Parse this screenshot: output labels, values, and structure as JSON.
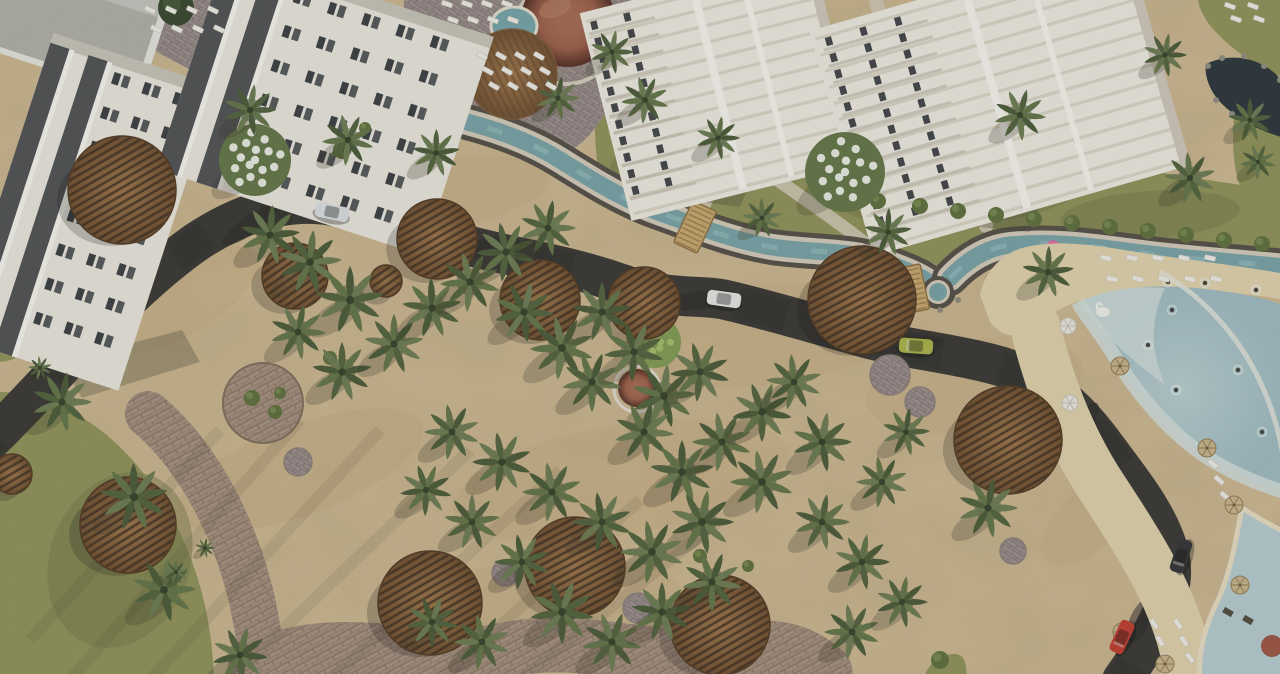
{
  "scene": {
    "width": 1280,
    "height": 674,
    "kind": "aerial-resort-rendering"
  },
  "palette": {
    "sand": "#d5c095",
    "sandDark": "#c2a173",
    "road": "#31302b",
    "roadDark": "#242320",
    "grass": "#8d9052",
    "grassDark": "#6e7440",
    "canalStone": "#4e483f",
    "canalRim": "#d6cdba",
    "canalWater": "#74a2a6",
    "canalRipple": "#9ec7c6",
    "brick": "#a5917f",
    "brickJoint": "#8b7663",
    "plaza": "#9b8e8b",
    "plazaJoint": "#7f7370",
    "gravel": "#d2c9b2",
    "woodLight": "#8f673c",
    "woodDark": "#5d3f22",
    "slat": "#332313",
    "domeHi": "#9a5a42",
    "domeLo": "#4e241a",
    "facade": "#eceadf",
    "facadeDark": "#3a3d40",
    "window": "#33373b",
    "towerFace": "#f1eee4",
    "towerStripe": "#d8d2c1",
    "towerWin": "#3b3e42",
    "waterDeep": "#9dbcc3",
    "waterMid": "#b9d0d2",
    "waterShallow": "#d3e0dc",
    "poolRim": "#ead fc4",
    "lounger": "#f3f1ea",
    "pond": "#222e33",
    "carWhite1": "#dde2e4",
    "carWhite2": "#e9e9e7",
    "carLime": "#a9b243",
    "carDark": "#2b2b2e",
    "carRed": "#c13527",
    "floatPink": "#e2699f",
    "swanWhite": "#f4f4f0",
    "blossom": "#f2f5ee"
  },
  "road": {
    "d": "M -25 455 C 45 390 115 300 195 243 C 238 214 285 198 333 206 C 385 215 420 233 470 246 C 520 259 565 264 622 284 C 672 301 700 294 726 300 C 765 309 805 321 862 337 C 905 349 945 352 992 364 C 1040 376 1072 402 1102 442 C 1130 480 1162 518 1170 558 C 1177 596 1152 638 1122 680",
    "width": 40,
    "smudges": [
      [
        250,
        225,
        34,
        9,
        -35
      ],
      [
        480,
        248,
        40,
        9,
        -10
      ],
      [
        700,
        300,
        38,
        9,
        -8
      ],
      [
        900,
        345,
        42,
        9,
        -5
      ],
      [
        1080,
        428,
        30,
        10,
        -55
      ],
      [
        1152,
        556,
        26,
        11,
        -80
      ],
      [
        1140,
        620,
        24,
        10,
        -65
      ]
    ]
  },
  "canal": {
    "main": "M 238 -15 C 244 30 246 62 252 86 C 262 122 300 104 330 108 C 365 112 395 108 430 114 C 470 121 520 135 560 160 C 600 185 625 200 658 212 C 692 224 730 240 772 247 C 812 253 850 250 884 262 C 912 272 930 280 938 291",
    "lagoonArm": "M 950 278 C 965 262 985 248 1010 245 C 1060 240 1100 248 1150 254 C 1200 260 1250 263 1295 268",
    "stoneW": 36,
    "rimW": 26,
    "waterW": 17,
    "bulge": [
      938,
      292
    ],
    "rocks": [
      [
        205,
        62
      ],
      [
        216,
        84
      ],
      [
        230,
        100
      ],
      [
        258,
        104
      ],
      [
        940,
        310
      ],
      [
        958,
        300
      ],
      [
        920,
        300
      ]
    ]
  },
  "grass": [
    "M 0 392 C 30 392 60 402 92 424 C 130 450 162 492 185 544 C 203 586 212 628 214 678 L 0 678 Z",
    "M 0 330 L 36 336 C 30 352 18 360 0 362 Z",
    "M 598 172 C 610 140 640 110 688 100 C 740 92 800 108 860 120 C 930 134 1000 146 1070 158 C 1140 170 1210 180 1285 192 L 1285 250 C 1240 258 1190 252 1140 248 C 1090 244 1040 240 1005 244 C 980 247 962 258 948 272 C 930 258 900 252 868 254 C 820 258 780 250 740 240 C 700 230 660 210 630 190 C 615 180 602 176 598 172 Z",
    "M 598 170 C 592 120 594 70 604 30 C 612 0 618 -5 630 -5 L 672 -5 C 660 40 655 80 655 120 C 640 140 615 160 598 170 Z",
    "M 1198 0 L 1285 0 L 1285 78 C 1258 68 1232 50 1212 28 C 1204 18 1199 8 1198 0 Z",
    "M 1238 92 C 1252 86 1268 84 1285 86 L 1285 228 C 1268 220 1252 208 1242 190 C 1232 170 1230 130 1238 92 Z",
    "M 924 678 C 928 664 938 656 952 654 C 962 653 968 660 966 678 Z"
  ],
  "grassShade": [
    [
      120,
      560,
      70,
      90,
      20
    ],
    [
      700,
      160,
      90,
      34,
      -6
    ],
    [
      960,
      195,
      120,
      30,
      -4
    ],
    [
      1150,
      215,
      90,
      24,
      -4
    ]
  ],
  "plazas": [
    "M 404 0 L 632 0 L 628 58 C 618 92 610 108 602 118 C 588 140 572 152 560 156 C 540 142 520 134 498 130 C 474 124 450 120 430 116 L 402 56 Z",
    "M 138 0 L 240 0 L 250 52 C 236 66 222 74 208 78 C 186 68 164 56 146 46 Z"
  ],
  "brickPaths": [
    {
      "d": "M 148 414 C 205 462 238 540 252 600 C 259 634 262 655 263 678",
      "w": 46
    },
    {
      "d": "M 255 668 C 340 628 420 668 505 650 C 590 632 650 668 730 652 C 770 644 800 648 825 672",
      "w": 55
    }
  ],
  "gravelPaths": [
    {
      "d": "M 876 2 C 892 50 912 88 944 126 C 968 156 982 190 986 226",
      "w": 14
    },
    {
      "d": "M 640 -4 C 628 20 618 44 616 66",
      "w": 12
    },
    {
      "d": "M 697 222 C 712 190 724 160 734 128",
      "w": 12
    },
    {
      "d": "M 772 176 C 826 214 874 246 908 282",
      "w": 13
    }
  ],
  "sandPatches": [
    [
      430,
      195,
      120,
      36,
      -8
    ],
    [
      760,
      335,
      150,
      50,
      -6
    ],
    [
      975,
      385,
      110,
      45,
      -10
    ],
    [
      300,
      470,
      130,
      45,
      -20
    ],
    [
      620,
      480,
      170,
      55,
      -10
    ],
    [
      180,
      300,
      90,
      35,
      -30
    ],
    [
      1090,
      520,
      60,
      30,
      -40
    ],
    [
      540,
      600,
      140,
      40,
      -5
    ]
  ],
  "shadowStreaks": [
    [
      70,
      680,
      300,
      420
    ],
    [
      150,
      680,
      380,
      430
    ],
    [
      230,
      680,
      470,
      450
    ],
    [
      330,
      680,
      560,
      470
    ],
    [
      440,
      680,
      640,
      500
    ],
    [
      30,
      640,
      220,
      430
    ],
    [
      520,
      680,
      720,
      520
    ]
  ],
  "lagoon": {
    "beach": "M 980 295 C 985 272 1000 255 1022 248 C 1060 238 1100 246 1150 254 C 1205 262 1255 268 1285 274 L 1285 300 C 1240 292 1180 286 1130 290 C 1090 294 1058 306 1035 326 C 1020 340 1002 338 990 322 Z",
    "beachBand": "M 1035 326 C 1048 380 1070 440 1105 492 C 1140 545 1168 590 1182 640 C 1188 660 1186 670 1184 678",
    "water": "M 1078 302 C 1110 288 1150 284 1195 288 C 1240 292 1272 300 1285 306 L 1285 492 C 1258 484 1230 472 1205 456 C 1172 434 1140 398 1118 362 C 1100 332 1085 316 1078 302 Z",
    "shallowWedge": "M 1078 302 C 1110 288 1140 286 1165 288 C 1150 320 1150 350 1165 385 C 1130 360 1100 330 1082 308 Z",
    "shallowEdge": "M 1078 302 C 1085 316 1100 332 1118 362 C 1140 398 1172 434 1205 456 C 1230 472 1258 484 1285 492",
    "waveArc": "M 1160 272 C 1210 300 1248 348 1268 400 C 1280 432 1284 458 1284 470",
    "kidsPool": "M 1242 508 C 1258 518 1272 526 1285 532 L 1285 678 L 1200 678 C 1198 654 1204 628 1218 600 C 1230 574 1236 540 1242 508 Z",
    "playground": [
      [
        1228,
        612
      ],
      [
        1248,
        620
      ]
    ],
    "terracotta": [
      1272,
      646,
      11
    ]
  },
  "pond": {
    "d": "M 1206 64 C 1226 54 1250 56 1268 68 C 1280 76 1285 84 1285 92 L 1285 138 C 1262 132 1238 120 1222 104 C 1210 92 1204 76 1206 64 Z",
    "rocks": [
      [
        1208,
        66
      ],
      [
        1222,
        58
      ],
      [
        1244,
        56
      ],
      [
        1264,
        66
      ],
      [
        1280,
        80
      ],
      [
        1216,
        100
      ],
      [
        1232,
        114
      ],
      [
        1252,
        124
      ]
    ]
  },
  "bridges": [
    {
      "x": 393,
      "y": 110,
      "rot": 95,
      "w": 42,
      "h": 24
    },
    {
      "x": 695,
      "y": 227,
      "rot": 115,
      "w": 46,
      "h": 26
    },
    {
      "x": 912,
      "y": 289,
      "rot": 78,
      "w": 46,
      "h": 26
    },
    {
      "x": 158,
      "y": 86,
      "rot": 20,
      "w": 38,
      "h": 20
    }
  ],
  "buildings": [
    {
      "cx": 86,
      "cy": 212,
      "rot": 18,
      "w": 172,
      "h": 320,
      "bands": [
        -86,
        -46
      ],
      "bandW": 20,
      "win": {
        "x0": -16,
        "y0": -142,
        "cols": 3,
        "rows": 8,
        "dx": 32,
        "dy": 36
      }
    },
    {
      "cx": 325,
      "cy": 103,
      "rot": 18,
      "w": 280,
      "h": 230,
      "bands": [
        -140,
        -98
      ],
      "bandW": 22,
      "win": {
        "x0": -62,
        "y0": -98,
        "cols": 5,
        "rows": 6,
        "dx": 36,
        "dy": 36
      }
    }
  ],
  "roofCorner": {
    "cx": 40,
    "cy": 18,
    "rot": 18
  },
  "buildingShadows": [
    "M 60 362 L 182 330 L 200 362 L 82 398 Z",
    "M 640 150 L 760 160 L 740 207 L 628 192 Z",
    "M 880 160 L 1052 174 L 1030 232 L 868 216 Z"
  ],
  "towers": [
    {
      "cx": 722,
      "cy": 88,
      "rot": -14,
      "w": 240,
      "h": 214,
      "floors": 12,
      "win": {
        "x0": -112,
        "y0": -96,
        "cols": 2,
        "rows": 11,
        "dx": 17,
        "dy": 17
      }
    },
    {
      "cx": 1000,
      "cy": 98,
      "rot": -16,
      "w": 330,
      "h": 234,
      "floors": 13,
      "win": {
        "x0": -152,
        "y0": -106,
        "cols": 3,
        "rows": 12,
        "dx": 18,
        "dy": 17
      }
    }
  ],
  "domeComplex": {
    "ring": [
      566,
      32,
      52
    ],
    "dome": [
      568,
      20,
      47
    ],
    "pool": [
      514,
      26,
      23,
      19
    ],
    "deck": [
      512,
      74,
      45
    ],
    "gazebo": {
      "ring": [
        637,
        389,
        23
      ],
      "dome": [
        637,
        388,
        19
      ]
    }
  },
  "parasols": [
    [
      122,
      190,
      54,
      -30
    ],
    [
      295,
      276,
      33,
      -35
    ],
    [
      437,
      239,
      40,
      -30
    ],
    [
      386,
      281,
      16,
      -35
    ],
    [
      540,
      300,
      40,
      -30
    ],
    [
      644,
      303,
      36,
      -35
    ],
    [
      862,
      300,
      54,
      -28
    ],
    [
      1008,
      440,
      54,
      -30
    ],
    [
      128,
      525,
      48,
      -32
    ],
    [
      430,
      603,
      52,
      -30
    ],
    [
      575,
      567,
      50,
      -28
    ],
    [
      720,
      625,
      50,
      -30
    ],
    [
      12,
      474,
      20,
      -30
    ]
  ],
  "paverCircles": [
    [
      340,
      152,
      25
    ],
    [
      890,
      375,
      20
    ],
    [
      920,
      402,
      15
    ],
    [
      298,
      462,
      14
    ],
    [
      505,
      573,
      13
    ],
    [
      638,
      608,
      15
    ],
    [
      1013,
      551,
      13
    ]
  ],
  "planter": [
    263,
    403,
    40
  ],
  "palms": [
    [
      250,
      110,
      26
    ],
    [
      348,
      140,
      26
    ],
    [
      436,
      153,
      24
    ],
    [
      558,
      98,
      22
    ],
    [
      612,
      52,
      22
    ],
    [
      645,
      100,
      24
    ],
    [
      718,
      138,
      22
    ],
    [
      762,
      218,
      20
    ],
    [
      888,
      232,
      24
    ],
    [
      1020,
      115,
      26
    ],
    [
      1165,
      55,
      22
    ],
    [
      1190,
      178,
      26
    ],
    [
      1250,
      120,
      22
    ],
    [
      1258,
      162,
      18
    ],
    [
      270,
      235,
      30
    ],
    [
      310,
      262,
      32
    ],
    [
      350,
      300,
      34
    ],
    [
      298,
      332,
      28
    ],
    [
      342,
      372,
      30
    ],
    [
      394,
      344,
      30
    ],
    [
      432,
      308,
      30
    ],
    [
      470,
      282,
      30
    ],
    [
      506,
      252,
      30
    ],
    [
      548,
      228,
      28
    ],
    [
      524,
      312,
      30
    ],
    [
      562,
      348,
      32
    ],
    [
      602,
      312,
      30
    ],
    [
      592,
      382,
      30
    ],
    [
      634,
      352,
      30
    ],
    [
      664,
      396,
      32
    ],
    [
      700,
      372,
      30
    ],
    [
      644,
      432,
      30
    ],
    [
      682,
      472,
      32
    ],
    [
      722,
      442,
      30
    ],
    [
      762,
      412,
      30
    ],
    [
      794,
      382,
      28
    ],
    [
      822,
      442,
      30
    ],
    [
      762,
      482,
      32
    ],
    [
      702,
      522,
      32
    ],
    [
      652,
      552,
      32
    ],
    [
      602,
      522,
      30
    ],
    [
      552,
      492,
      30
    ],
    [
      502,
      462,
      30
    ],
    [
      452,
      432,
      28
    ],
    [
      562,
      612,
      32
    ],
    [
      612,
      642,
      30
    ],
    [
      662,
      612,
      30
    ],
    [
      712,
      582,
      30
    ],
    [
      522,
      562,
      28
    ],
    [
      472,
      522,
      28
    ],
    [
      426,
      490,
      26
    ],
    [
      482,
      642,
      28
    ],
    [
      432,
      622,
      26
    ],
    [
      822,
      522,
      28
    ],
    [
      862,
      562,
      28
    ],
    [
      882,
      482,
      26
    ],
    [
      906,
      432,
      24
    ],
    [
      852,
      632,
      28
    ],
    [
      902,
      602,
      26
    ],
    [
      62,
      402,
      30
    ],
    [
      134,
      497,
      34
    ],
    [
      164,
      590,
      32
    ],
    [
      240,
      655,
      28
    ],
    [
      176,
      572,
      12
    ],
    [
      205,
      548,
      10
    ],
    [
      40,
      368,
      12
    ],
    [
      1048,
      272,
      26
    ],
    [
      988,
      508,
      30
    ]
  ],
  "bushes": [
    [
      920,
      206,
      8
    ],
    [
      958,
      211,
      8
    ],
    [
      996,
      215,
      8
    ],
    [
      1034,
      219,
      8
    ],
    [
      1072,
      223,
      8
    ],
    [
      1110,
      227,
      8
    ],
    [
      1148,
      231,
      8
    ],
    [
      1186,
      235,
      8
    ],
    [
      1224,
      240,
      8
    ],
    [
      1262,
      244,
      8
    ],
    [
      838,
      196,
      8
    ],
    [
      878,
      201,
      8
    ],
    [
      700,
      556,
      7
    ],
    [
      748,
      566,
      6
    ],
    [
      330,
      358,
      7
    ],
    [
      252,
      398,
      8
    ],
    [
      275,
      412,
      7
    ],
    [
      280,
      393,
      6
    ],
    [
      940,
      660,
      9
    ],
    [
      342,
      150,
      9
    ],
    [
      365,
      128,
      6
    ]
  ],
  "floweringTrees": [
    [
      255,
      160,
      36
    ],
    [
      845,
      172,
      40
    ]
  ],
  "lightTrees": [
    [
      655,
      342,
      26
    ]
  ],
  "darkTrees": [
    [
      176,
      8,
      18
    ]
  ],
  "loungerGroups": [
    {
      "x": 150,
      "y": 10,
      "cols": 4,
      "rows": 2,
      "dx": 21,
      "dy": 19,
      "rot": 25
    },
    {
      "x": 447,
      "y": 4,
      "cols": 4,
      "rows": 2,
      "dx": 20,
      "dy": 16,
      "rot": 20
    },
    {
      "x": 482,
      "y": 56,
      "cols": 4,
      "rows": 3,
      "dx": 19,
      "dy": 15,
      "rot": 30
    },
    {
      "x": 1106,
      "y": 258,
      "cols": 5,
      "rows": 2,
      "dx": 26,
      "dy": 21,
      "rot": 12
    },
    {
      "x": 1154,
      "y": 624,
      "cols": 2,
      "rows": 3,
      "dx": 24,
      "dy": 17,
      "rot": 55
    },
    {
      "x": 1213,
      "y": 464,
      "cols": 1,
      "rows": 3,
      "dx": 0,
      "dy": 16,
      "rot": 40
    },
    {
      "x": 1230,
      "y": 6,
      "cols": 2,
      "rows": 2,
      "dx": 23,
      "dy": 13,
      "rot": 20
    }
  ],
  "umbrellasStraw": [
    [
      1120,
      366
    ],
    [
      1207,
      448
    ],
    [
      1234,
      505
    ],
    [
      1122,
      632
    ],
    [
      1165,
      664
    ],
    [
      1240,
      585
    ]
  ],
  "umbrellasWhite": [
    [
      1068,
      326
    ],
    [
      1070,
      403
    ]
  ],
  "cars": [
    {
      "x": 332,
      "y": 212,
      "rot": 12,
      "color": "#dde2e4"
    },
    {
      "x": 724,
      "y": 299,
      "rot": 8,
      "color": "#e9e9e7"
    },
    {
      "x": 916,
      "y": 346,
      "rot": 4,
      "color": "#a9b243"
    },
    {
      "x": 1181,
      "y": 556,
      "rot": -72,
      "color": "#2b2b2e"
    },
    {
      "x": 1122,
      "y": 637,
      "rot": -65,
      "color": "#c13527"
    }
  ],
  "people": [
    [
      1168,
      282
    ],
    [
      1205,
      283
    ],
    [
      1256,
      290
    ],
    [
      1172,
      310
    ],
    [
      1238,
      370
    ],
    [
      1176,
      390
    ],
    [
      1148,
      345
    ],
    [
      1262,
      432
    ]
  ],
  "floats": {
    "pinkDonut": [
      1053,
      247
    ],
    "swan": [
      1103,
      312
    ]
  }
}
